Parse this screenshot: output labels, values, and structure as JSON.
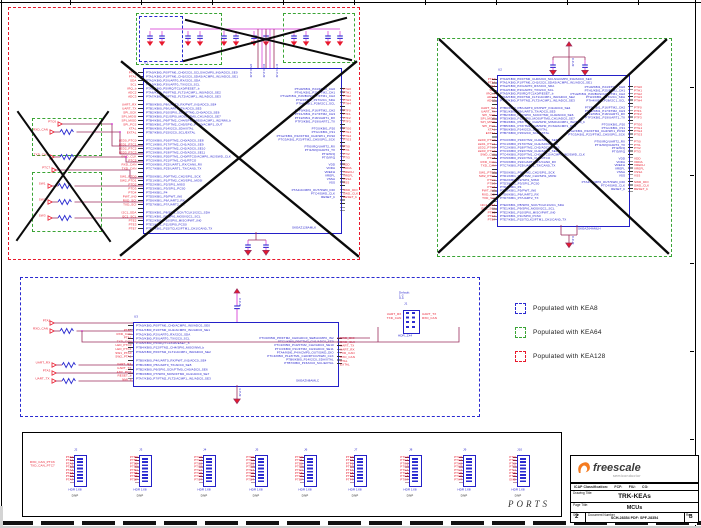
{
  "legend": {
    "items": [
      {
        "label": "Populated with KEA8",
        "color": "#2a2ad0"
      },
      {
        "label": "Populated with KEA64",
        "color": "#3aa435"
      },
      {
        "label": "Populated with KEA128",
        "color": "#e8192c"
      }
    ]
  },
  "pins": {
    "left_inner": [
      "PTA0/KBI0_P0/FTM0_CH0/I2C0_SCLS/ACMP0_IN0/ADC0_SE0",
      "PTA1/KBI0_P1/FTM0_CH1/I2C0_SDAS/ACMP0_IN1/ADC0_SE1",
      "PTA2/KBI0_P2/UART0_RX/I2C0_SDA",
      "PTA3/KBI0_P3/UART0_TX/I2C0_SCL",
      "PTA5/KBI0_P5/IRQ/TCLK0/RESET_b",
      "PTA6/KBI0_P6/FTM2_FLT1/ACMP1_IN0/ADC0_SE2",
      "PTA7/KBI0_P7/FTM2_FLT2/ACMP1_IN1/ADC0_SE3",
      "",
      "PTB0/KBI0_P8/UART0_RX/PWT_IN1/ADC0_SE4",
      "PTB1/KBI0_P9/UART0_TX/ADC0_SE5",
      "PTB2/KBI0_P10/SPI0_SCK/FTM0_CH0/ADC0_SE6",
      "PTB3/KBI0_P11/SPI0_MOSI/FTM0_CH1/ADC0_SE7",
      "PTB4/KBI1_P6/FTM2_CH4/SPI0_MISO/ACMP1_IN2/NMI_b",
      "PTB5/KBI1_P7/FTM2_CH5/SPI0_PCS0/ACMP1_OUT",
      "PTB6/KBI0_P14/I2C0_SDA/XTAL",
      "PTB7/KBI0_P15/I2C0_SCL/EXTAL",
      "",
      "PTC0/KBI0_P16/FTM2_CH0/ADC0_SE8",
      "PTC1/KBI0_P17/FTM2_CH1/ADC0_SE9",
      "PTC2/KBI0_P18/FTM2_CH2/ADC0_SE10",
      "PTC3/KBI0_P19/FTM2_CH3/ADC0_SE11",
      "PTC4/KBI0_P20/FTM1_CH0/RTCO/ACMP0_IN2/SWD_CLK",
      "PTC5/KBI0_P21/FTM1_CH1/RTCO",
      "PTC6/KBI0_P22/UART1_RX/CAN0_RX",
      "PTC7/KBI0_P23/UART1_TX/CAN0_TX",
      "",
      "PTD0/KBI1_P0/FTM2_CH2/SPI1_SCK",
      "PTD1/KBI1_P1/FTM2_CH3/SPI1_MOSI",
      "PTD2/KBI1_P2/SPI1_MISO",
      "PTD3/KBI1_P3/SPI1_PCS0",
      "PTD4/KBI1_P4",
      "PTD5/KBI1_P5/PWT_IN0",
      "PTD6/KBI1_P6/UART2_RX",
      "PTD7/KBI1_P7/UART2_TX",
      "",
      "PTE0/KBI1_P8/SPI0_SCK/TCLK1/I2C1_SDA",
      "PTE1/KBI1_P9/SPI0_MOSI/I2C1_SCL",
      "PTE2/KBI1_P10/SPI0_MISO/PWT_IN0",
      "PTE3/KBI1_P11/SPI0_PCS0",
      "PTE7/KBI1_P15/TCLK2/FTM1_CH1/CAN0_TX"
    ],
    "left_outer": [
      "PTA0",
      "PTA1",
      "SDA",
      "SCL",
      "IRQ_b",
      "ADC2",
      "ADC3",
      "",
      "UART_RX",
      "UART_TX",
      "SPI_SCK",
      "SPI_MOSI",
      "SPI_MISO",
      "SPI_PCS",
      "XTAL",
      "EXTAL",
      "",
      "LED0_PTC0",
      "LED1_PTC1",
      "LED2_PTC2",
      "LED3_PTC3",
      "SWD_CLK",
      "PTC5",
      "RXD_CAN",
      "TXD_CAN",
      "",
      "SW1_PTD0",
      "SW2_PTD1",
      "PTD2",
      "PTD3",
      "PTD4",
      "PWT_IN0",
      "RXD_SCI",
      "TXD_SCI",
      "",
      "I2C1_SDA",
      "I2C1_SCL",
      "PTE2",
      "PTE3",
      "PTE7"
    ],
    "right_inner": [
      "PTH0/KBI1_P24/FTM2_CH0",
      "PTH1/KBI1_P25/FTM2_CH1",
      "PTH2/KBI1_P26/BUSOUT/FTM1_CH2",
      "PTH3/KBI1_P27/I2C1_SDA",
      "PTH4/KBI1_P28/I2C1_SCL",
      "",
      "PTF0/KBI1_P16/FTM2_CH2",
      "PTF1/KBI1_P17/FTM2_CH3",
      "PTF2/KBI1_P18/UART1_RX",
      "PTF3/KBI1_P19/UART1_TX",
      "",
      "PTG0/KBI1_P20",
      "PTG1/KBI1_P21",
      "PTG2/KBI1_P22/FTM2_CH4/SPI1_PCS0",
      "PTG3/KBI1_P23/FTM2_CH5/SPI1_SCK",
      "",
      "PTI0/IRQ/UART2_RX",
      "PTI1/IRQ/UART2_TX",
      "PTI2/IRQ",
      "PTI3/IRQ",
      "",
      "VDD",
      "VDDA",
      "VREFH",
      "VREFL",
      "VSSA",
      "VSS",
      "",
      "PTA4/ACMP0_OUT/SWD_DIO",
      "PTC4/SWD_CLK",
      "RESET_b"
    ],
    "right_outer": [
      "PTH0",
      "PTH1",
      "PTH2",
      "PTH3",
      "PTH4",
      "",
      "PTF0",
      "PTF1",
      "PTF2",
      "PTF3",
      "",
      "PTG0",
      "PTG1",
      "PTG2",
      "PTG3",
      "",
      "PTI0",
      "PTI1",
      "PTI2",
      "PTI3",
      "",
      "VDD",
      "VDDA",
      "VREFH",
      "VREFL",
      "VSSA",
      "VSS",
      "",
      "SWD_DIO",
      "SWD_CLK",
      "RESET_b"
    ],
    "mid_left_inner": [
      "PTA0/KBI0_P0/FTM0_CH0/ACMP0_IN0/ADC0_SE0",
      "PTA1/KBI0_P1/FTM0_CH1/ACMP0_IN1/ADC0_SE1",
      "PTA2/KBI0_P2/UART0_RX/I2C0_SDA",
      "PTA3/KBI0_P3/UART0_TX/I2C0_SCL",
      "PTA5/KBI0_P5/IRQ/TCLK0/RESET_b",
      "PTB4/KBI0_P12/FTM2_CH4/SPI0_MISO/NMI_b",
      "PTA6/KBI0_P6/FTM2_FLT1/ACMP1_IN0/ADC0_SE2",
      "",
      "PTB0/KBI0_P4/UART0_RX/PWT_IN1/ADC0_SE4",
      "PTB1/KBI0_P5/UART0_TX/ADC0_SE5",
      "PTB2/KBI0_P6/SPI0_SCK/FTM0_CH0/ADC0_SE6",
      "PTB3/KBI0_P7/SPI0_MOSI/FTM0_CH1/ADC0_SE7",
      "PTA7/KBI0_P7/FTM2_FLT2/ACMP1_IN1/ADC0_SE3"
    ],
    "mid_right_inner": [
      "PTC0/KBI0_P8/FTM2_CH0/ADC0_SE8/ACMP0_IN2",
      "PTC1/KBI0_P9/FTM2_CH1/ADC0_SE9",
      "PTC2/KBI0_P10/FTM2_CH2/ADC0_SE10",
      "PTC3/KBI0_P11/FTM2_CH3/ADC0_SE11",
      "PTA4/KBI0_P4/ACMP0_OUT/SWD_DIO",
      "PTC4/KBI0_P12/FTM1_CH0/RTCO/SWD_CLK",
      "PTB6/KBI0_P14/I2C0_SDA/XTAL",
      "PTB7/KBI0_P15/I2C0_SCL/EXTAL"
    ],
    "mid_left_nets": [
      "PTA0",
      "RXD_CAN",
      "PTA1",
      "TXD_CAN",
      "LED_PTC0",
      "LED_PTC1",
      "SW1_PTA0",
      "SW2_PTA1",
      "",
      "UART_RX",
      "UART_TX",
      "ADC_POT",
      "RESET_b",
      "NMI_b"
    ],
    "mid_right_nets": [
      "SWD_DIO",
      "SWD_CLK",
      "UART_TX",
      "UART_RX",
      "TXD_CAN",
      "RXD_CAN",
      "XTAL",
      "EXTAL"
    ]
  },
  "mcus": {
    "u1": {
      "ref": "U1",
      "part": "SKEAZ128AMLK"
    },
    "u2": {
      "ref": "U2",
      "part": "SKEAZ64AMLH"
    },
    "u3": {
      "ref": "U3",
      "part": "SKEAZN8AMLC"
    }
  },
  "decaps": {
    "bank_labels": [
      "C5 0.1UF",
      "C6 0.1UF",
      "C7 4.7UF"
    ],
    "cap_top": "0.1UF",
    "cap_bot": "4.7UF"
  },
  "left_circuit": {
    "rows": [
      "PTC6",
      "RXD_CAN",
      "TXD_CAN",
      "PTC7",
      "SW1",
      "SW2",
      "SW3"
    ]
  },
  "mid_circuit": {
    "rows": [
      "PTA2",
      "RXD_CAN",
      "UART_RX",
      "PTA3",
      "UART_TX"
    ],
    "swd": {
      "ref": "J1",
      "left": [
        "UART_RX",
        "TXD_CAN"
      ],
      "right": [
        "UART_TX",
        "RXD_CAN"
      ],
      "note": [
        "Default:",
        "1-2",
        "3-4"
      ],
      "part": "HDR_2X4"
    }
  },
  "ports": {
    "label": "PORTS",
    "connectors": [
      {
        "ref": "J2",
        "nets": [
          "PTA0",
          "PTA1",
          "PTA2",
          "PTA3",
          "PTA4",
          "PTA5",
          "PTA6",
          "PTA7"
        ],
        "extra": [
          "RXD_CAN_PTC6",
          "TXD_CAN_PTC7"
        ],
        "part": "HDR 1X8",
        "dnp": "DNP"
      },
      {
        "ref": "J3",
        "nets": [
          "PTB0",
          "PTB1",
          "PTB2",
          "PTB3",
          "PTB4",
          "PTB5",
          "PTB6",
          "PTB7"
        ],
        "extra": [],
        "part": "HDR 1X8",
        "dnp": "DNP"
      },
      {
        "ref": "J4",
        "nets": [
          "PTC0",
          "PTC1",
          "PTC2",
          "PTC3",
          "PTC4",
          "PTC5",
          "PTC6",
          "PTC7"
        ],
        "extra": [],
        "part": "HDR 1X8",
        "dnp": "DNP"
      },
      {
        "ref": "J5",
        "nets": [
          "PTD0",
          "PTD1",
          "PTD2",
          "PTD3",
          "PTD4",
          "PTD5",
          "PTD6",
          "PTD7"
        ],
        "extra": [],
        "part": "HDR 1X8",
        "dnp": "DNP"
      },
      {
        "ref": "J6",
        "nets": [
          "PTE0",
          "PTE1",
          "PTE2",
          "PTE3",
          "PTE4",
          "PTE5",
          "PTE6",
          "PTE7"
        ],
        "extra": [],
        "part": "HDR 1X8",
        "dnp": "DNP"
      },
      {
        "ref": "J7",
        "nets": [
          "PTF0",
          "PTF1",
          "PTF2",
          "PTF3",
          "PTF4",
          "PTF5",
          "PTF6",
          "PTF7"
        ],
        "extra": [],
        "part": "HDR 1X8",
        "dnp": "DNP"
      },
      {
        "ref": "J8",
        "nets": [
          "PTG0",
          "PTG1",
          "PTG2",
          "PTG3",
          "PTG4",
          "PTG5",
          "PTG6",
          "PTG7"
        ],
        "extra": [],
        "part": "HDR 1X8",
        "dnp": "DNP"
      },
      {
        "ref": "J9",
        "nets": [
          "PTH0",
          "PTH1",
          "PTH2",
          "PTH3",
          "PTH4",
          "PTH5",
          "PTH6",
          "PTH7"
        ],
        "extra": [],
        "part": "HDR 1X8",
        "dnp": "DNP"
      },
      {
        "ref": "J10",
        "nets": [
          "PTI0",
          "PTI1",
          "PTI2",
          "PTI3",
          "PTI4",
          "PTI5",
          "PTI6",
          "GND"
        ],
        "extra": [],
        "part": "HDR 1X8",
        "dnp": "DNP"
      }
    ]
  },
  "title_block": {
    "brand": "freescale",
    "brand_sub": "semiconductor",
    "icap_row": "ICAP Classification:      FCF:      FIU:      CO:",
    "drawing_title_label": "Drawing Title:",
    "drawing_title": "TRK-KEAs",
    "page_title_label": "Page Title:",
    "page_title": "MCUs",
    "size_label": "Size",
    "size_value": "2",
    "doc_label": "Document Number",
    "doc_value": "SCH-28354 PDF: SPF-28354",
    "rev_label": "Rev",
    "rev_value": "B"
  }
}
